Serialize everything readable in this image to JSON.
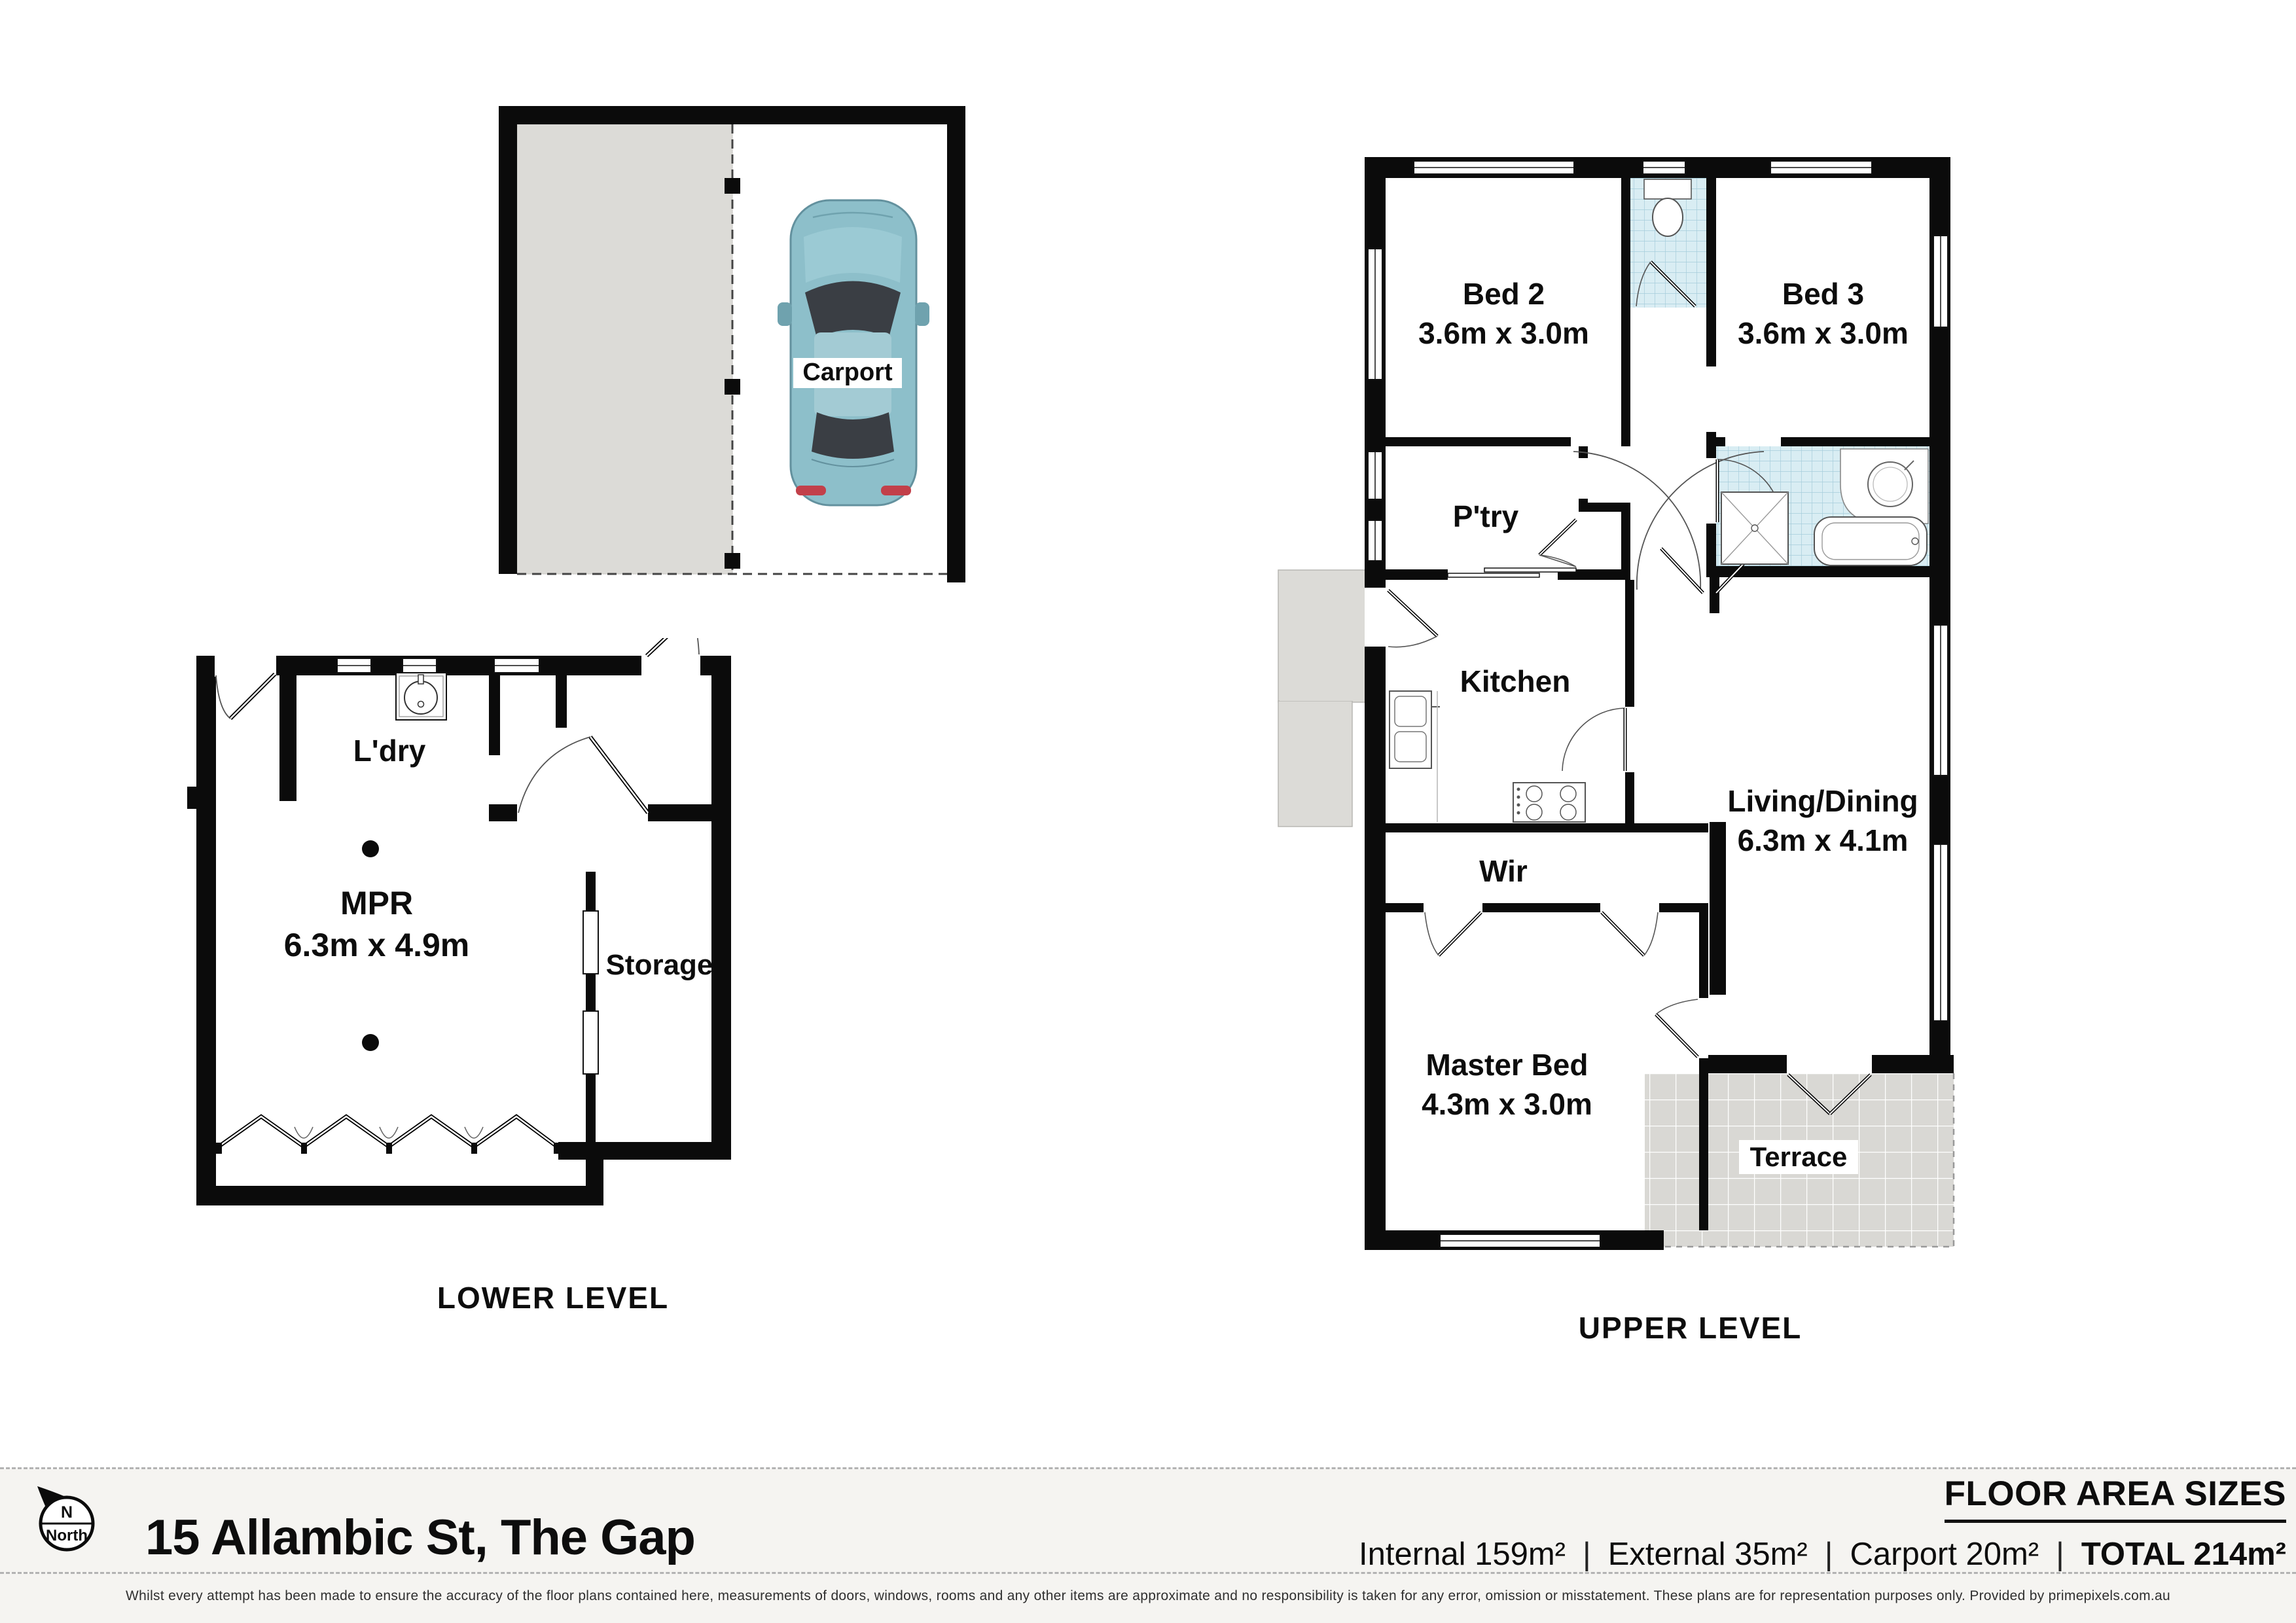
{
  "plan_title_levels": {
    "lower": "LOWER LEVEL",
    "upper": "UPPER LEVEL"
  },
  "rooms": {
    "carport": {
      "label": "Carport"
    },
    "ldry": {
      "label": "L'dry"
    },
    "mpr": {
      "name": "MPR",
      "dims": "6.3m x 4.9m"
    },
    "storage": {
      "label": "Storage"
    },
    "bed2": {
      "name": "Bed 2",
      "dims": "3.6m x 3.0m"
    },
    "bed3": {
      "name": "Bed 3",
      "dims": "3.6m x 3.0m"
    },
    "ptry": {
      "label": "P'try"
    },
    "kitchen": {
      "label": "Kitchen"
    },
    "living": {
      "name": "Living/Dining",
      "dims": "6.3m x 4.1m"
    },
    "wir": {
      "label": "Wir"
    },
    "master": {
      "name": "Master Bed",
      "dims": "4.3m x 3.0m"
    },
    "terrace": {
      "label": "Terrace"
    }
  },
  "compass": {
    "n": "N",
    "north": "North"
  },
  "footer": {
    "address": "15 Allambic St, The Gap",
    "floor_area_title": "FLOOR AREA SIZES",
    "areas": {
      "internal": "Internal 159m²",
      "external": "External 35m²",
      "carport": "Carport 20m²",
      "total": "TOTAL 214m²"
    },
    "separator": "|",
    "disclaimer": "Whilst every attempt has been made to ensure the accuracy of the floor plans contained here, measurements of doors, windows, rooms and any other items are approximate and no responsibility is taken for any error, omission or misstatement. These plans are for representation purposes only. Provided by primepixels.com.au"
  },
  "colors": {
    "wall": "#0b0b0b",
    "paving_gray": "#dcdbd7",
    "tile_blue": "#d9edf3",
    "tile_blue_line": "#a6cddb",
    "terrace_tile": "#d9d8d4",
    "footer_bg": "#f5f4f1",
    "car_body": "#8dbfca"
  }
}
